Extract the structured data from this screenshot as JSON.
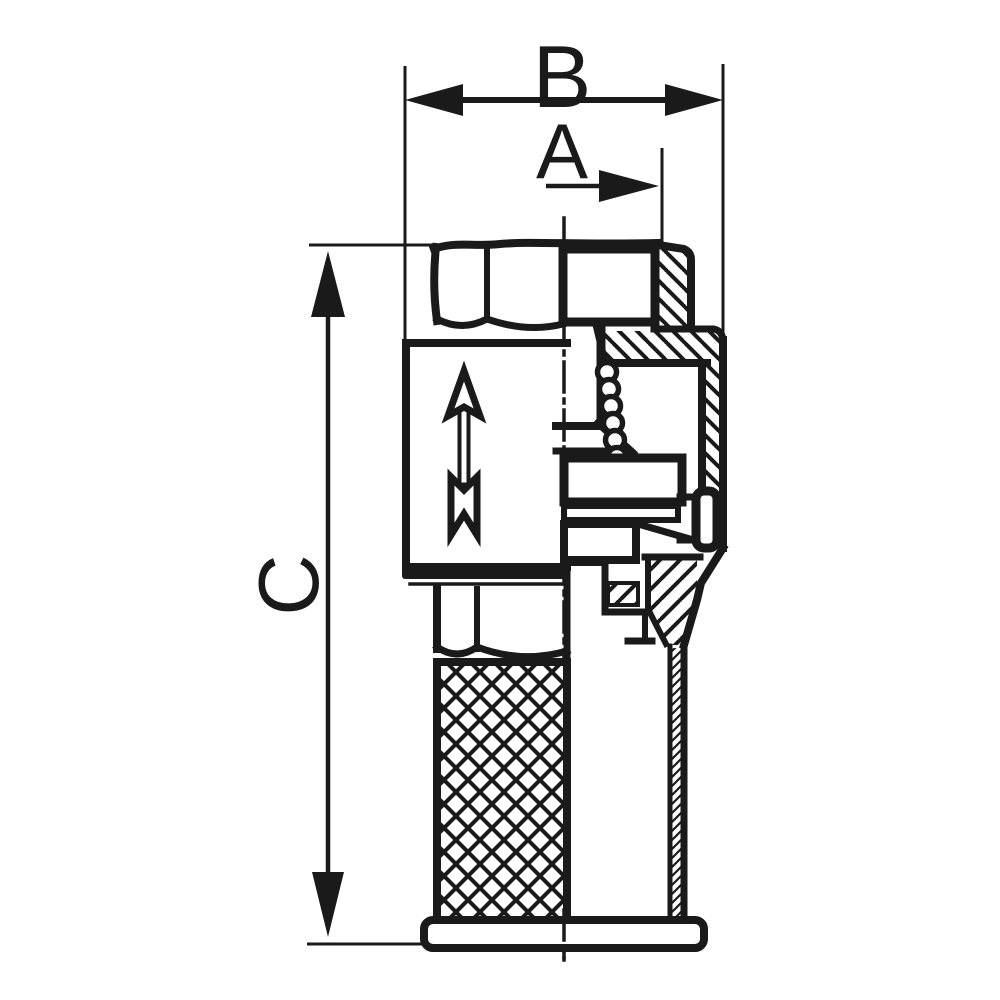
{
  "drawing": {
    "background_color": "#ffffff",
    "line_color": "#1a1a1a",
    "dimension_labels": {
      "a": "A",
      "b": "B",
      "c": "C"
    },
    "flow_arrow_direction": "up"
  }
}
